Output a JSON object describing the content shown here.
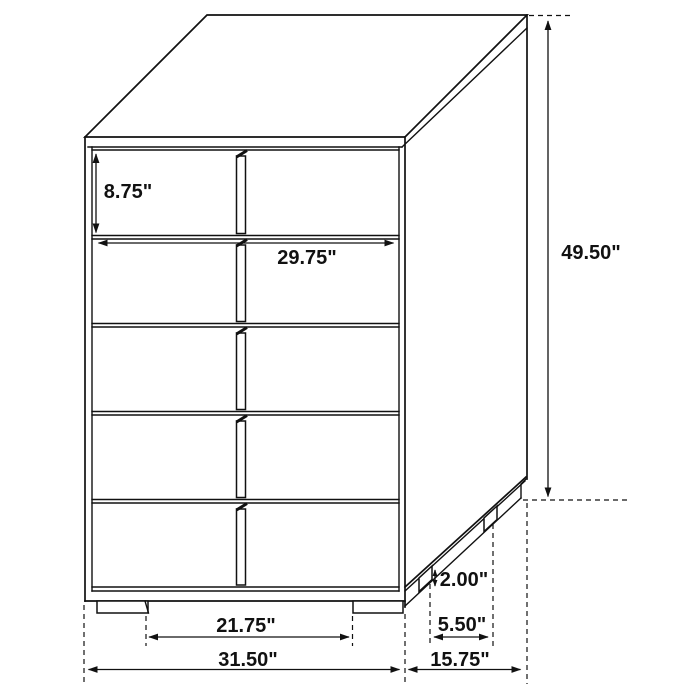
{
  "drawing": {
    "background": "#ffffff",
    "line_color": "#111111",
    "subject": "five-drawer-chest-dimension-diagram",
    "dims": {
      "drawer_height": "8.75\"",
      "drawer_width": "29.75\"",
      "overall_height": "49.50\"",
      "base_height": "2.00\"",
      "side_leg_gap": "5.50\"",
      "front_leg_gap": "21.75\"",
      "overall_width": "31.50\"",
      "overall_depth": "15.75\""
    }
  }
}
